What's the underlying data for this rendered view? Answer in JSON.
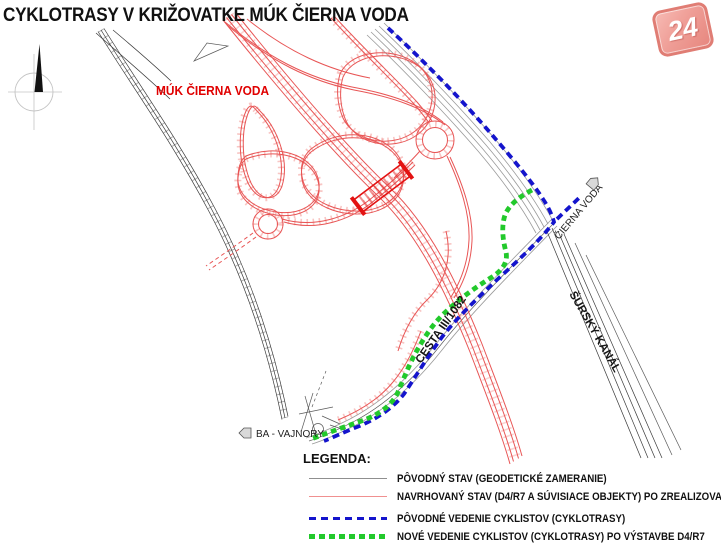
{
  "title": "CYKLOTRASY V KRIŽOVATKE MÚK ČIERNA VODA",
  "logo": {
    "text": "24"
  },
  "colors": {
    "route-original": "#1414cc",
    "route-new": "#22c92b",
    "proposed-red": "#e85555",
    "proposed-red-bold": "#e31212",
    "label-red": "#e00000",
    "logo-red": "#dd6f66"
  },
  "map": {
    "labels": {
      "interchange": "MÚK ČIERNA VODA",
      "destination_cierna_voda": "ČIERNA VODA",
      "canal": "ŠURSKÝ KANÁL",
      "road": "CESTA III/1082",
      "destination_vajnory": "BA - VAJNORY"
    }
  },
  "legend": {
    "heading": "LEGENDA:",
    "items": [
      {
        "label": "PÔVODNÝ STAV (GEODETICKÉ ZAMERANIE)"
      },
      {
        "label": "NAVRHOVANÝ STAV (D4/R7 A SÚVISIACE OBJEKTY) PO ZREALIZOVANÍ"
      },
      {
        "label": "PÔVODNÉ VEDENIE CYKLISTOV (CYKLOTRASY)"
      },
      {
        "label": "NOVÉ VEDENIE CYKLISTOV (CYKLOTRASY) PO VÝSTAVBE D4/R7"
      }
    ]
  }
}
